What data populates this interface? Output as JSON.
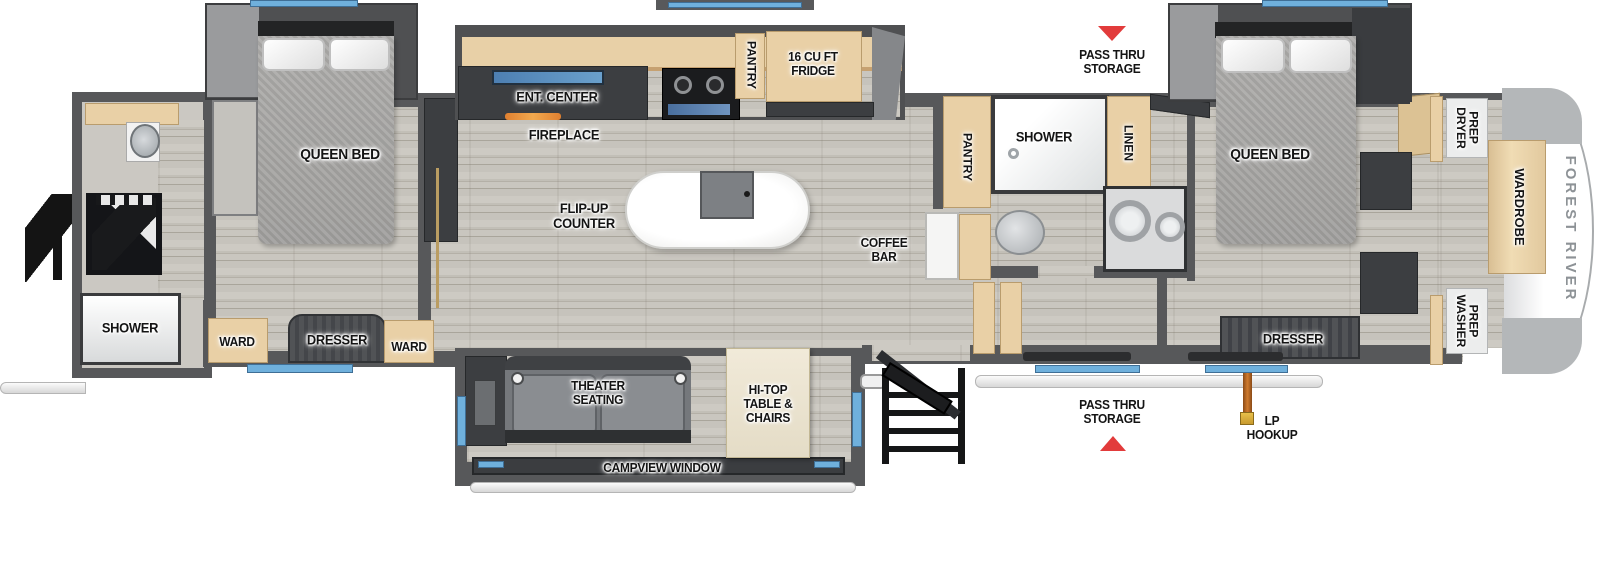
{
  "floorplan": {
    "brand_cap": "FOREST RIVER",
    "rear_bath": {
      "shower": "SHOWER"
    },
    "bedroom_left": {
      "bed": "QUEEN BED",
      "ward_left": "WARD",
      "dresser": "DRESSER",
      "ward_right": "WARD"
    },
    "kitchen": {
      "ent_center": "ENT. CENTER",
      "fireplace": "FIREPLACE",
      "pantry": "PANTRY",
      "fridge": "16 CU FT\nFRIDGE",
      "flip_up_counter": "FLIP-UP\nCOUNTER",
      "coffee_bar": "COFFEE\nBAR"
    },
    "storage": {
      "pass_thru_top": "PASS THRU\nSTORAGE",
      "pass_thru_bottom": "PASS THRU\nSTORAGE",
      "lp_hookup": "LP\nHOOKUP"
    },
    "mid_bath": {
      "pantry": "PANTRY",
      "shower": "SHOWER",
      "linen": "LINEN"
    },
    "bedroom_right": {
      "bed": "QUEEN BED",
      "dresser": "DRESSER",
      "dryer_prep": "DRYER\nPREP",
      "wardrobe": "WARDROBE",
      "washer_prep": "WASHER\nPREP"
    },
    "living": {
      "theater": "THEATER\nSEATING",
      "hitop": "HI-TOP\nTABLE &\nCHAIRS",
      "campview": "CAMPVIEW WINDOW"
    }
  },
  "icons": {
    "pass_thru_top_arrow": "red-triangle-down",
    "pass_thru_bottom_arrow": "red-triangle-up"
  },
  "colors": {
    "wall": "#57585a",
    "window_blue": "#6fb0dc",
    "arrow_red": "#e23b3b",
    "cabinet_tan": "#e9d0a6",
    "cap_text_gray": "#8d9296"
  }
}
